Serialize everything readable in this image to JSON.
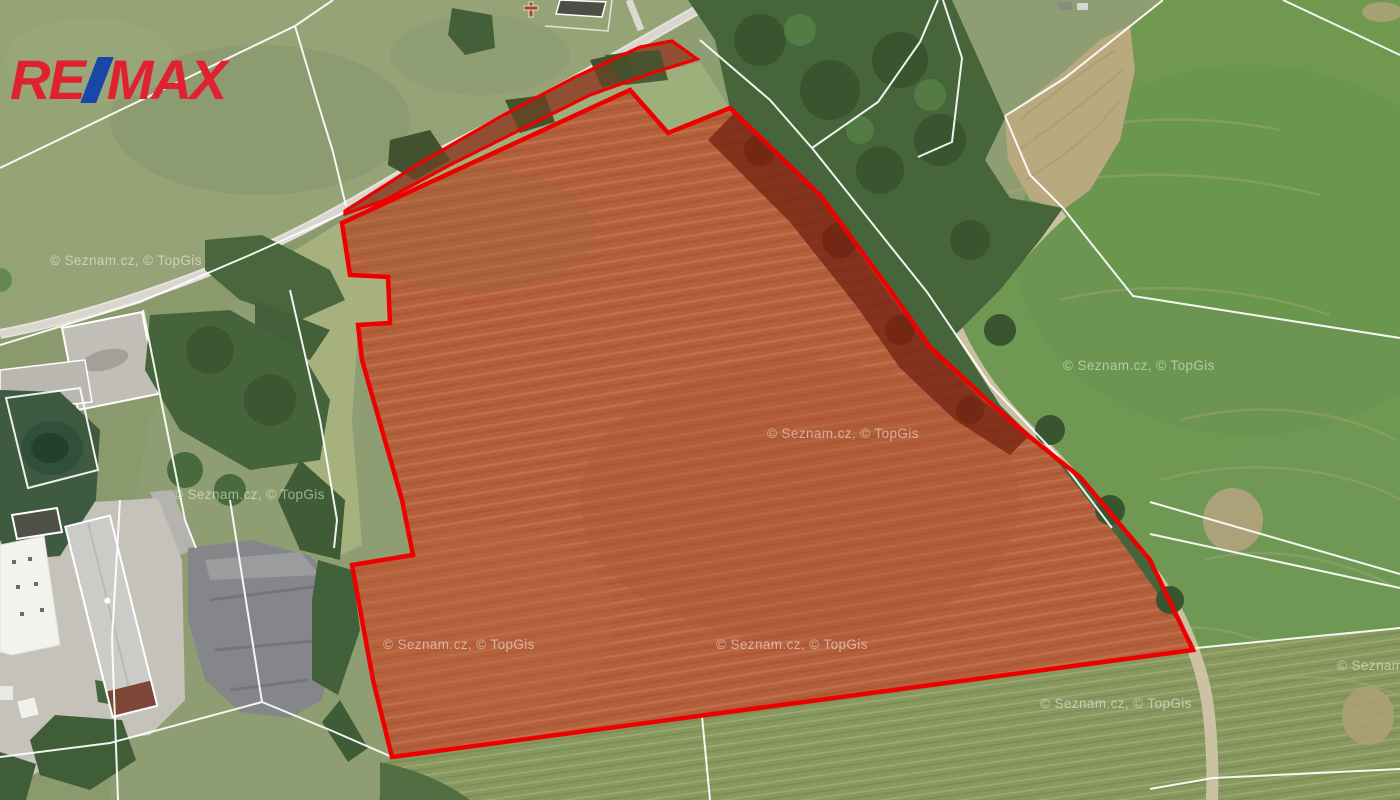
{
  "branding": {
    "logo_re": "RE",
    "logo_slash": "/",
    "logo_max": "MAX",
    "logo_red_color": "#E0212F",
    "logo_blue_color": "#1748A8"
  },
  "map": {
    "attribution_text": "© Seznam.cz, © TopGis",
    "boundary_color": "#EE0000",
    "cadastral_line_color": "#FFFFFF",
    "field_brown_color": "#A8714C",
    "forest_green_color": "#46653A",
    "meadow_green_color": "#8E9E72",
    "crop_green_color": "#70994F",
    "road_gray_color": "#E4E2DB",
    "quarry_gray_color": "#85868A",
    "watermark_color": "rgba(255,255,255,0.5)"
  }
}
